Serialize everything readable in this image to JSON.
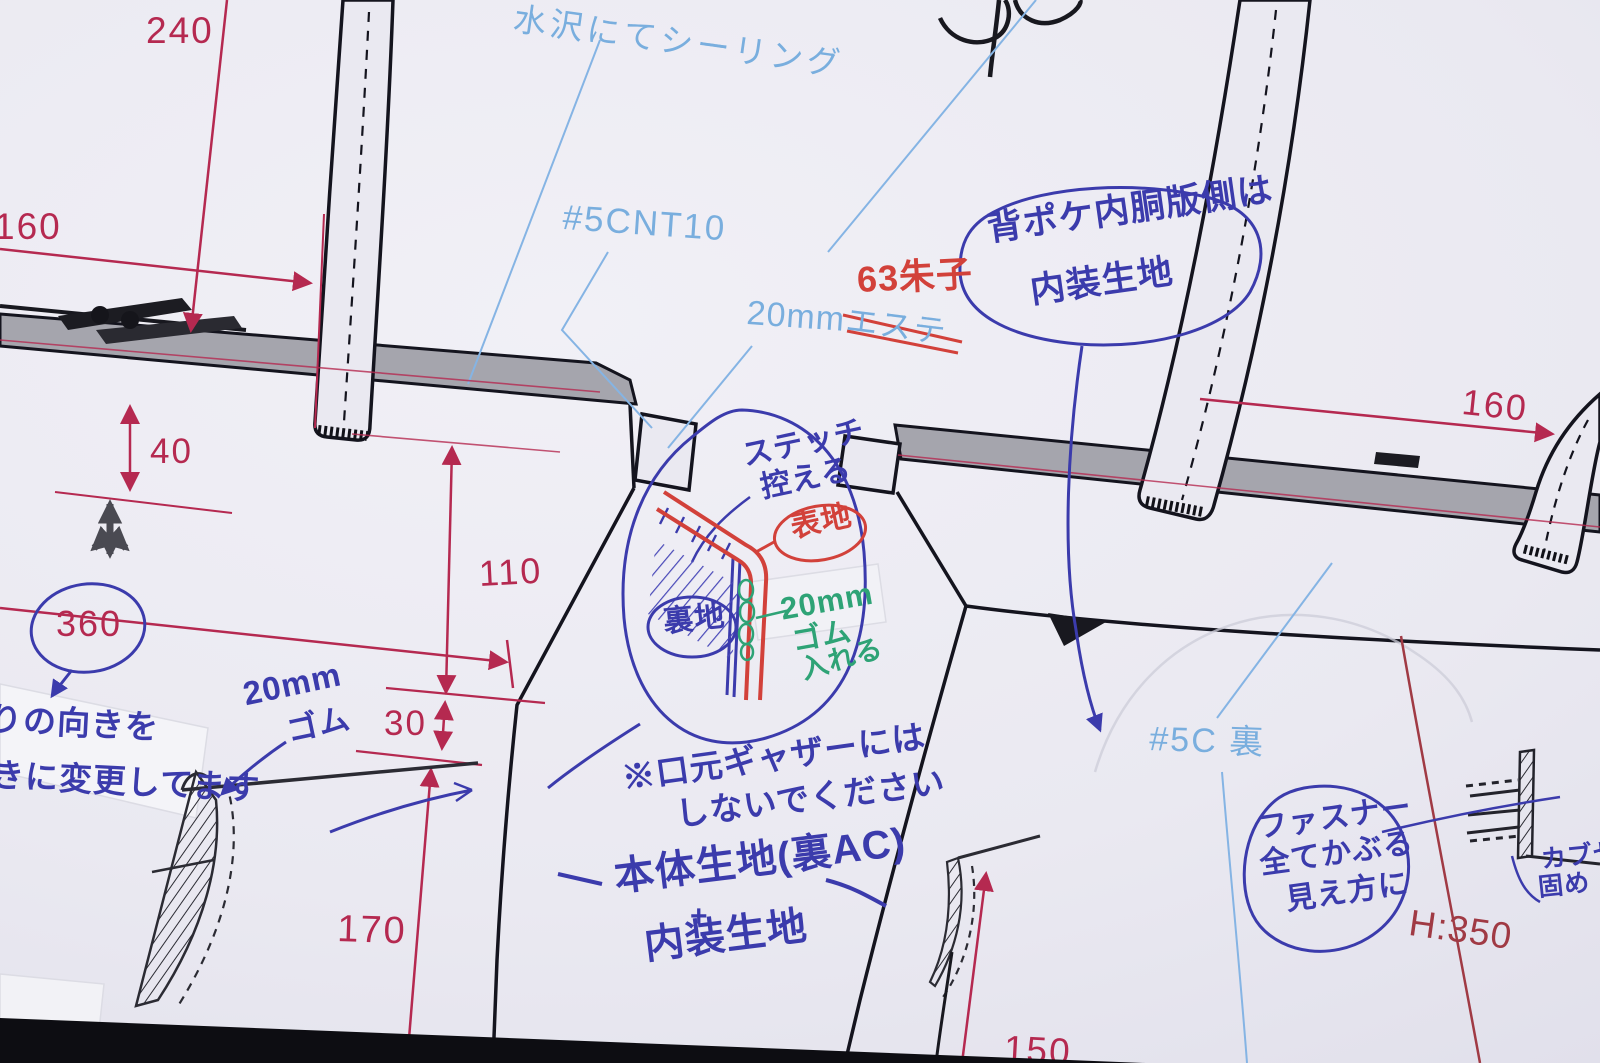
{
  "printed": {
    "sealing_note": "水沢にてシーリング",
    "part_no": "#5CNT10",
    "mm20": "20mm",
    "material_struck": "エステ",
    "back_label": "#5C 裏"
  },
  "dimensions": {
    "d240": "240",
    "d160_left": "160",
    "d40": "40",
    "d360": "360",
    "d110": "110",
    "d30": "30",
    "d170": "170",
    "d150": "150",
    "d160_right": "160",
    "height": "H:350"
  },
  "pen_red": {
    "satin": "63朱子",
    "outer_fabric": "表地"
  },
  "pen_blue": {
    "pocket_note_1": "背ポケ内胴版側は",
    "pocket_note_2": "内装生地",
    "stitch_1": "ステッチ",
    "stitch_2": "控える",
    "lining": "裏地",
    "gather_1": "※口元ギャザーには",
    "gather_2": "しないでください",
    "body_1": "本体生地(裏AC)",
    "body_plus": "+",
    "body_2": "内装生地",
    "fastener_1": "ファスナー",
    "fastener_2": "全てかぶる",
    "fastener_3": "見え方に",
    "flap_1": "カブセ",
    "flap_2": "固め",
    "elastic_1": "20mm",
    "elastic_2": "ゴム",
    "tape_note_1": "りの向きを",
    "tape_note_2": "きに変更してます"
  },
  "pen_green": {
    "l1": "20mm",
    "l2": "ゴム",
    "l3": "入れる"
  },
  "colors": {
    "dimension_red": "#b52950",
    "height_red": "#a03a44",
    "print_blue": "#79aede",
    "pen_blue": "#3b3bac",
    "pen_red": "#d2413a",
    "pen_green": "#2ea376",
    "paper": "#eae9f1",
    "band_gray": "#a5a5ad"
  }
}
